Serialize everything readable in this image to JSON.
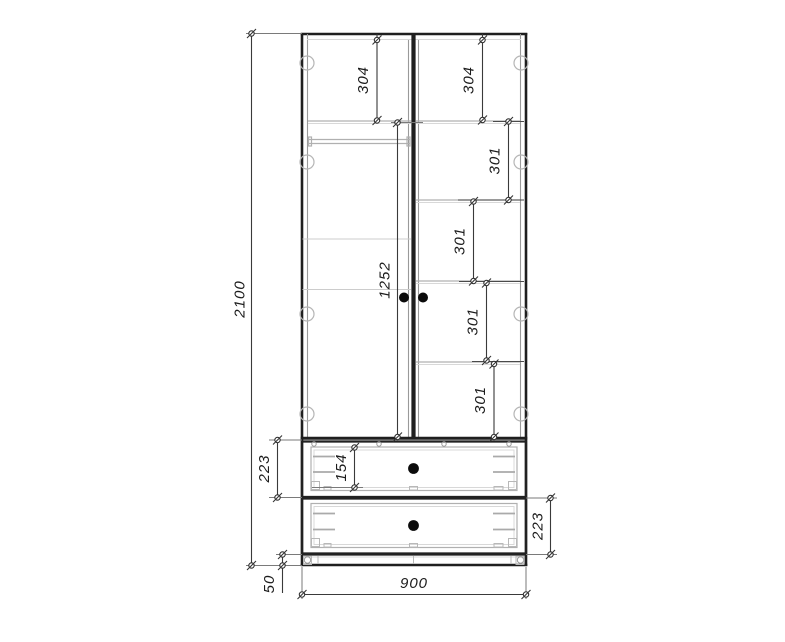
{
  "drawing": {
    "type": "furniture-elevation",
    "units": "mm",
    "background": "#ffffff",
    "line_color": "#1f1f1f",
    "dims": {
      "overall_height": "2100",
      "overall_width": "900",
      "plinth_height": "50",
      "left_top_section": "304",
      "right_top_section": "304",
      "right_section_1": "301",
      "right_section_2": "301",
      "right_section_3": "301",
      "right_section_4": "301",
      "door_height": "1252",
      "top_drawer_height": "223",
      "top_drawer_front_height": "154",
      "bottom_drawer_height": "223"
    }
  }
}
